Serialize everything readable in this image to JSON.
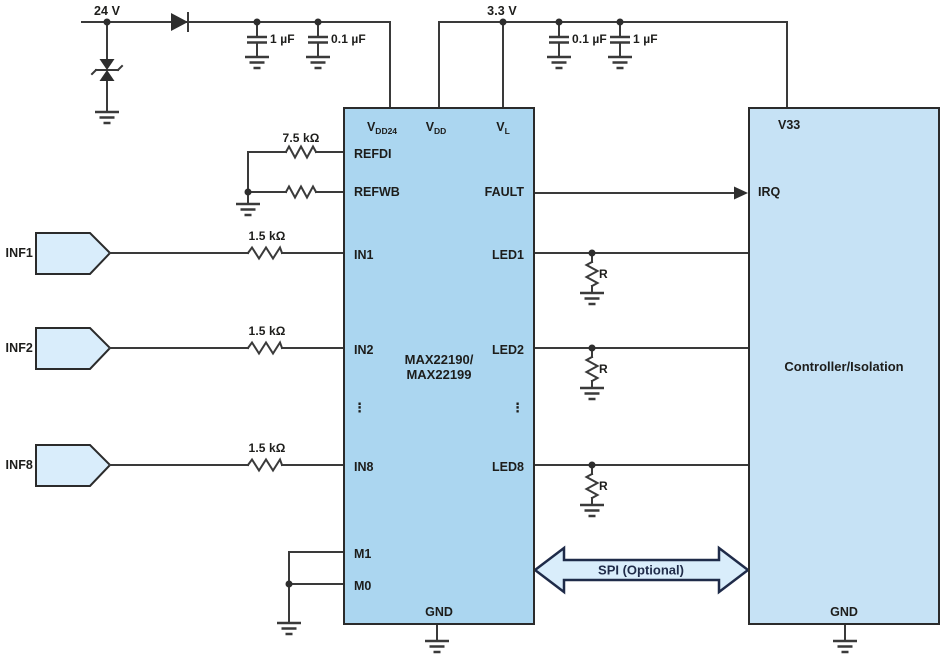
{
  "colors": {
    "ic_fill": "#abd6f0",
    "controller_fill": "#c6e2f5",
    "arrow_fill": "#d9edfb",
    "wire": "#3a3a3a",
    "text": "#1d1d1b",
    "spi_navy": "#1f2b49"
  },
  "power_24v": {
    "label": "24 V",
    "caps": [
      "1 µF",
      "0.1 µF"
    ]
  },
  "power_3v3": {
    "label": "3.3 V",
    "caps": [
      "0.1 µF",
      "1 µF"
    ]
  },
  "reference": {
    "resistor_label": "7.5 kΩ"
  },
  "inputs": [
    {
      "label": "INF1",
      "resistor": "1.5 kΩ"
    },
    {
      "label": "INF2",
      "resistor": "1.5 kΩ"
    },
    {
      "label": "INF8",
      "resistor": "1.5 kΩ"
    }
  ],
  "ic": {
    "name_line1": "MAX22190/",
    "name_line2": "MAX22199",
    "pins_top": [
      {
        "base": "V",
        "sub": "DD24"
      },
      {
        "base": "V",
        "sub": "DD"
      },
      {
        "base": "V",
        "sub": "L"
      }
    ],
    "pins_left": [
      "REFDI",
      "REFWB",
      "IN1",
      "IN2",
      "IN8",
      "M1",
      "M0"
    ],
    "pins_right": [
      "FAULT",
      "LED1",
      "LED2",
      "LED8"
    ],
    "pin_bottom": "GND",
    "ellipsis": "⋮"
  },
  "led_resistors": [
    {
      "label": "R"
    },
    {
      "label": "R"
    },
    {
      "label": "R"
    }
  ],
  "spi": {
    "label": "SPI (Optional)"
  },
  "controller": {
    "pin_top": "V33",
    "pin_left": "IRQ",
    "pin_bottom": "GND",
    "title": "Controller/Isolation"
  }
}
